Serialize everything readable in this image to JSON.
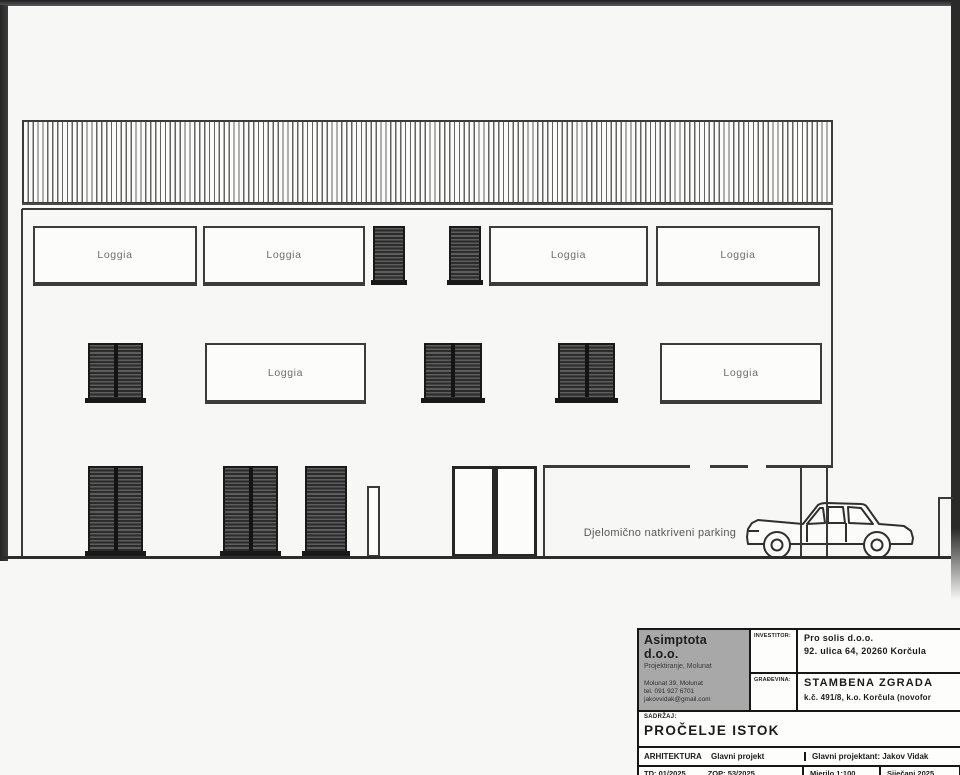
{
  "drawing": {
    "loggia_label": "Loggia",
    "parking_label": "Djelomično natkriveni parking"
  },
  "title_block": {
    "company": {
      "name": "Asimptota d.o.o.",
      "subtitle": "Projektiranje, Molunat",
      "address": "Molunat 39, Molunat",
      "phone": "tel. 091 927 6701",
      "email": "jakovvidak@gmail.com"
    },
    "investor": {
      "label": "INVESTITOR:",
      "line1": "Pro solis d.o.o.",
      "line2": "92. ulica 64, 20260 Korčula"
    },
    "building": {
      "label": "GRAĐEVINA:",
      "line1": "STAMBENA ZGRADA",
      "line2": "k.č. 491/8, k.o. Korčula (novofor"
    },
    "content": {
      "label": "SADRŽAJ:",
      "value": "PROČELJE ISTOK"
    },
    "discipline_row": {
      "discipline": "ARHITEKTURA",
      "project_type": "Glavni projekt",
      "designer": "Glavni projektant: Jakov Vidak"
    },
    "meta_row": {
      "td": "TD: 01/2025",
      "zop": "ZOP: 53/2025",
      "scale": "Mjerilo 1:100",
      "date": "Siječanj 2025"
    }
  },
  "colors": {
    "line": "#3a3a3a",
    "dark_frame": "#161616",
    "shutter_dark": "#2c2c2c",
    "company_cell_gray": "#a8a8a8",
    "label_gray": "#6e6e6e",
    "paper": "#f7f7f5"
  }
}
